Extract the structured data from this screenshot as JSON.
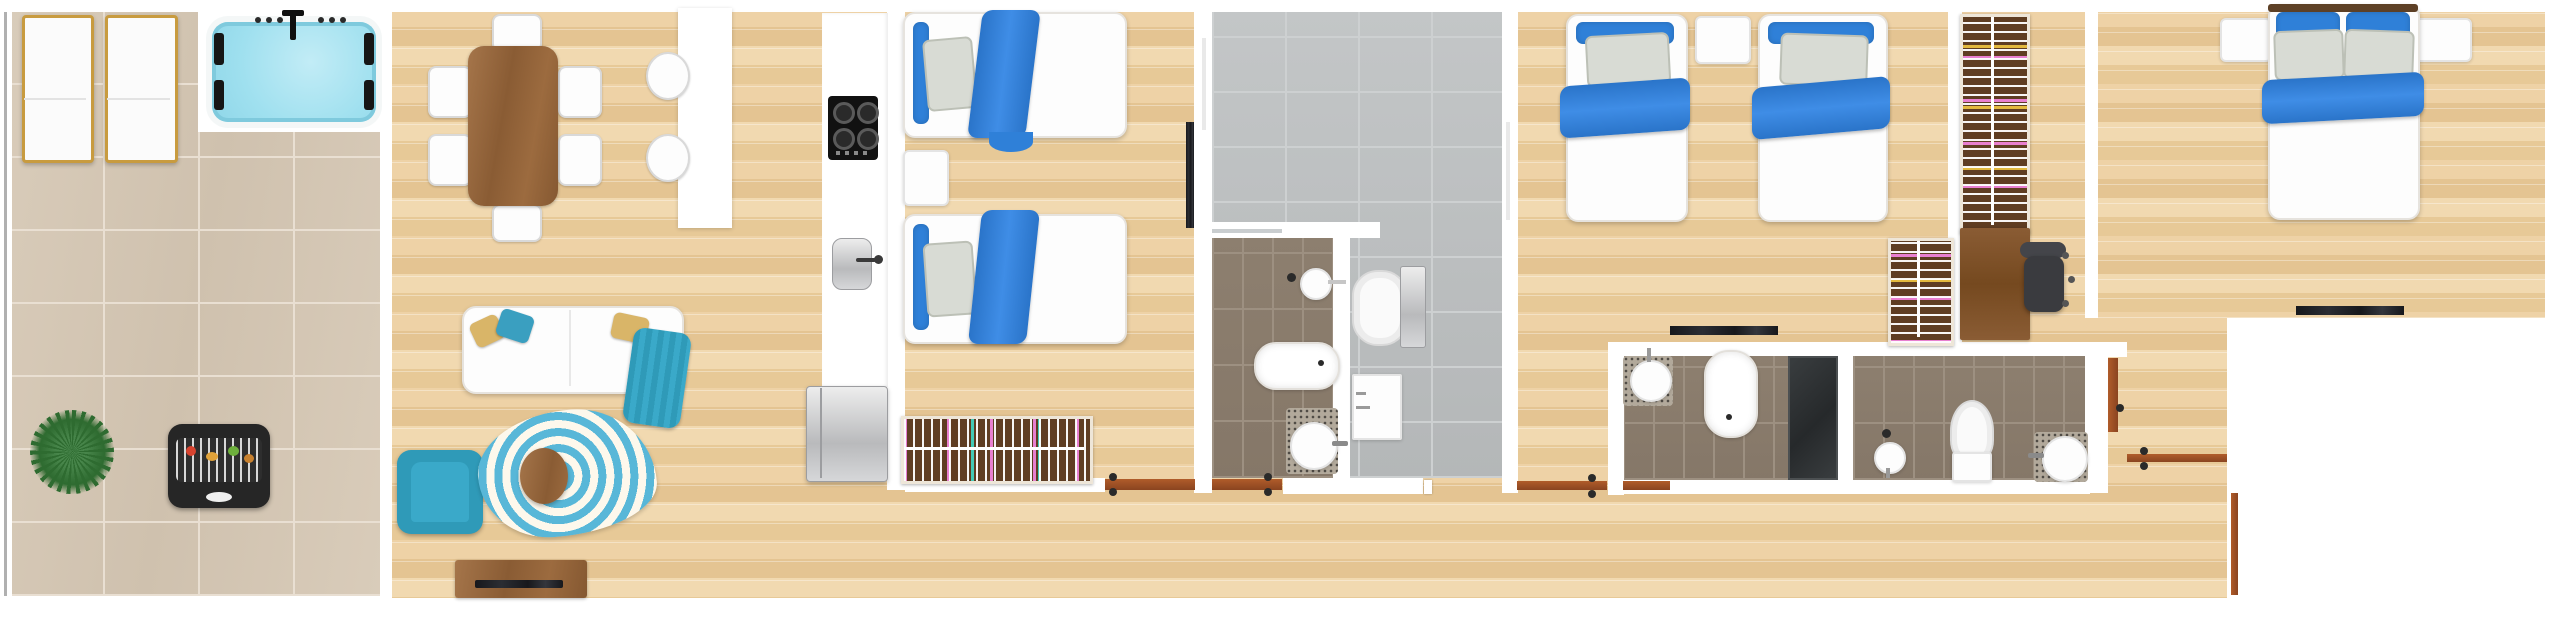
{
  "meta": {
    "title": "Apartment floor plan — 3D top-down render",
    "canvas": {
      "width": 2560,
      "height": 622
    }
  },
  "palette": {
    "background": "#ffffff",
    "wall": "#ffffff",
    "wood_floor": "#ecd0a4",
    "terrace_tile": "#d5c8b6",
    "bath_tile_gray": "#bcc0c1",
    "bath_tile_brown": "#8d7f6f",
    "door_threshold": "#a8572b",
    "bedding_blue": "#2f80d8",
    "pillow_gray": "#d8dbd4",
    "pillow_sand": "#d9b568",
    "accent_teal": "#2f9ab8",
    "furniture_wood": "#9c6b3f",
    "dark_appliance": "#262626",
    "steel": "#c7c8ca",
    "hot_tub_water": "#9fe0ef",
    "plant_green": "#2e6b30",
    "mosaic": "#b2a99b",
    "shower_dark": "#34383a"
  },
  "rooms": {
    "terrace": {
      "label": "Terrace",
      "items": {
        "lounger_1": "Sun lounger",
        "lounger_2": "Sun lounger",
        "hot_tub": "Hot tub (jacuzzi)",
        "hot_tub_faucet": "Hot tub faucet",
        "jets": "Hot tub jets",
        "plant": "Potted plant",
        "bbq": "Barbecue grill",
        "railing": "Glass railing"
      }
    },
    "living": {
      "label": "Living / dining room",
      "items": {
        "dining_table": "Dining table",
        "dining_chair": "Dining chair",
        "island": "Kitchen island counter",
        "stool": "Bar stool",
        "sofa": "Sofa",
        "cushion_sand": "Sand cushion",
        "cushion_teal": "Teal cushion",
        "throw": "Throw blanket",
        "armchair": "Armchair",
        "rug": "Rug",
        "coffee_table": "Coffee table",
        "tv_bench": "TV bench",
        "tv": "Television"
      }
    },
    "kitchen": {
      "label": "Kitchen",
      "items": {
        "counter": "Kitchen counter",
        "cooktop": "Cooktop (4 burners)",
        "sink": "Kitchen sink",
        "fridge": "Refrigerator"
      }
    },
    "bedroom1": {
      "label": "Bedroom 1 (twin)",
      "items": {
        "bed_a": "Single bed",
        "bed_b": "Single bed",
        "nightstand": "Nightstand",
        "rack": "Clothes rack",
        "tv": "Wall-mounted TV",
        "door": "Door threshold"
      }
    },
    "bathroom1": {
      "label": "Bathroom 1 (wet room)",
      "items": {
        "shower_area": "Walk-in shower area",
        "towel_rail": "Towel rail",
        "toilet": "Toilet",
        "vanity": "Vanity cabinet",
        "wall_sink": "Wash basin",
        "bathtub": "Bathtub",
        "round_sink": "Round basin",
        "door": "Door threshold",
        "glass": "Glass screen"
      }
    },
    "bedroom2": {
      "label": "Bedroom 2 (twin)",
      "items": {
        "bed_a": "Single bed",
        "bed_b": "Single bed",
        "nightstand": "Nightstand",
        "tv": "Wall-mounted TV",
        "wardrobe": "Wardrobe",
        "door": "Door threshold"
      }
    },
    "dressing": {
      "label": "Dressing / study nook",
      "items": {
        "wardrobe": "Open wardrobe",
        "desk": "Desk",
        "chair": "Office chair"
      }
    },
    "master": {
      "label": "Master bedroom",
      "items": {
        "bed": "Double bed",
        "nightstand_l": "Nightstand",
        "nightstand_r": "Nightstand",
        "tv": "Wall-mounted TV"
      }
    },
    "bathroom2": {
      "label": "Bathroom 2 (en-suite strip)",
      "items": {
        "basin_left": "Round basin",
        "bathtub": "Bathtub",
        "shower": "Shower",
        "basin_mid": "Wash basin",
        "toilet": "Toilet",
        "basin_right": "Round basin",
        "door_left": "Door threshold",
        "door_right": "Door threshold"
      }
    },
    "hallway": {
      "label": "Hallway / entry",
      "items": {
        "entry_door": "Entrance door threshold",
        "side_door": "Side door threshold"
      }
    }
  }
}
